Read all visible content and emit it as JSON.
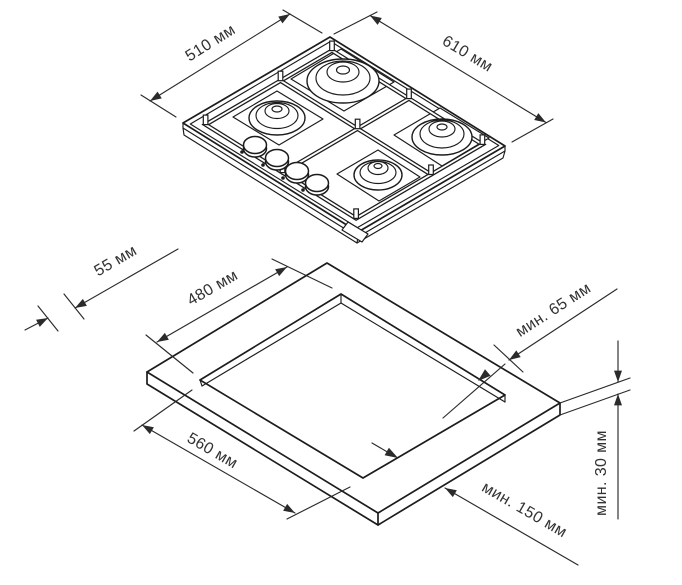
{
  "diagram": {
    "hob": {
      "depth_label": "510 мм",
      "width_label": "610 мм"
    },
    "cutout": {
      "front_offset_label": "55 мм",
      "depth_label": "480 мм",
      "width_label": "560 мм",
      "rear_clearance_label": "мин. 65 мм",
      "side_clearance_label": "мин. 150 мм",
      "thickness_label": "мин. 30 мм"
    }
  }
}
